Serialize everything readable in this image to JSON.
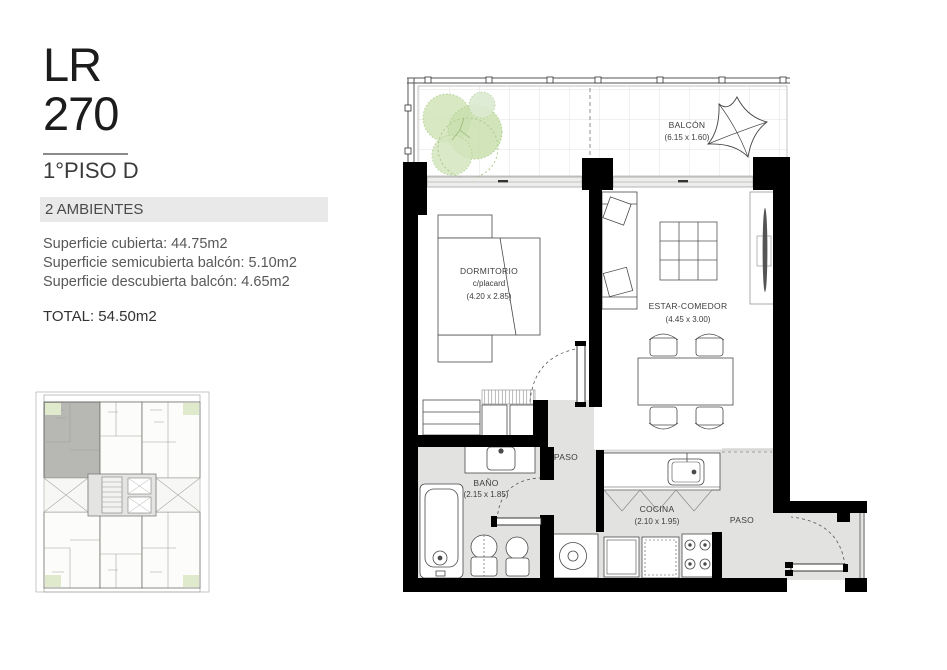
{
  "header": {
    "code_top": "LR",
    "code_bottom": "270",
    "floor_label": "1°PISO D",
    "unit_type": "2 AMBIENTES"
  },
  "areas": {
    "lines": [
      "Superficie cubierta: 44.75m2",
      "Superficie semicubierta balcón: 5.10m2",
      "Superficie descubierta balcón: 4.65m2"
    ],
    "total": "TOTAL: 54.50m2"
  },
  "floorplan": {
    "balcony_label": "BALCÓN",
    "balcony_dims": "(6.15 x 1.60)",
    "bedroom_label": "DORMITORIO",
    "bedroom_sub": "c/placard",
    "bedroom_dims": "(4.20 x 2.85)",
    "living_label": "ESTAR-COMEDOR",
    "living_dims": "(4.45 x 3.00)",
    "bath_label": "BAÑO",
    "bath_dims": "(2.15 x 1.85)",
    "kitchen_label": "COCINA",
    "kitchen_dims": "(2.10 x 1.95)",
    "hall_label_1": "PASO",
    "hall_label_2": "PASO"
  },
  "colors": {
    "wall": "#000000",
    "floor_gray": "#e2e2e0",
    "accent_bar": "#e9e9e9",
    "highlight_unit": "#b7b7b3",
    "plant_green": "#cfe3b4"
  }
}
